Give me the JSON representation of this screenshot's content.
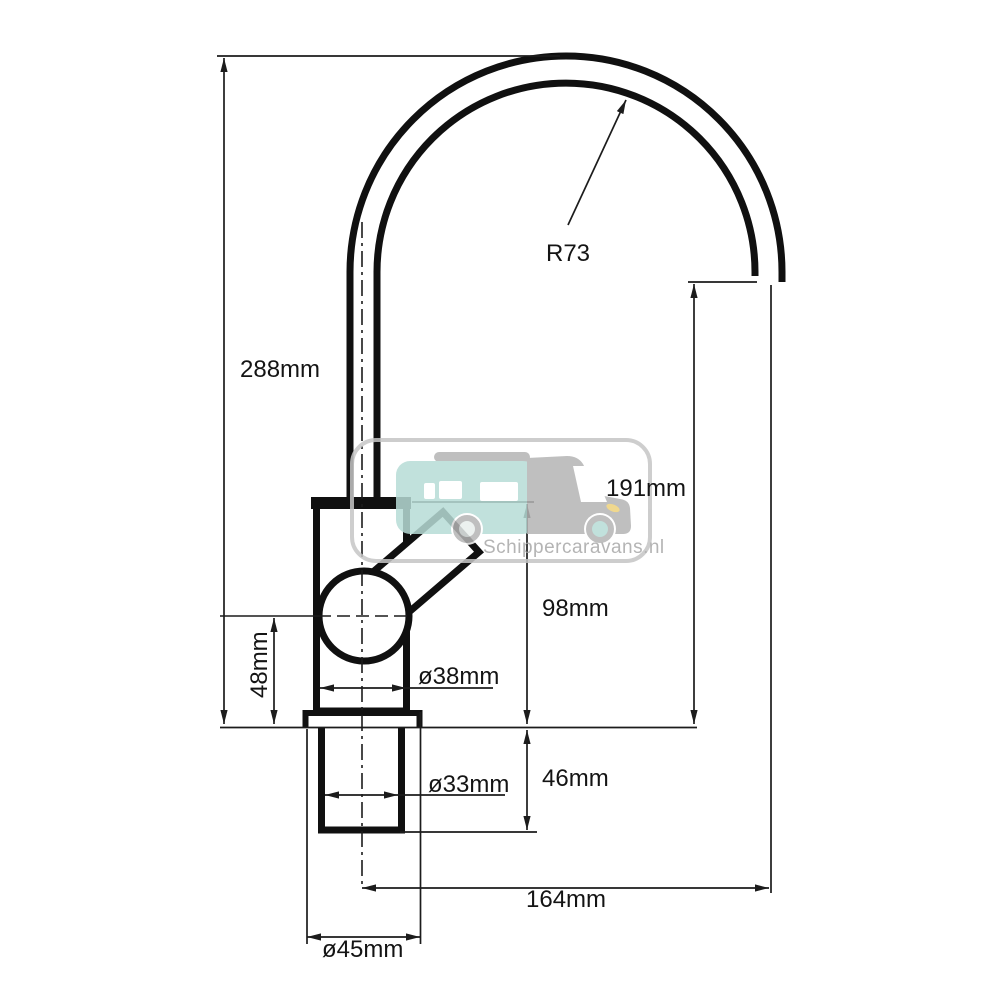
{
  "page": {
    "background": "#ffffff",
    "description": "Technical dimension drawing of a single-lever caravan faucet with gooseneck spout"
  },
  "diagram": {
    "type": "technical-drawing",
    "labels": {
      "overall_height": "288mm",
      "spout_radius": "R73",
      "spout_height": "191mm",
      "body_height": "98mm",
      "handle_axis_height": "48mm",
      "body_diameter": "ø38mm",
      "thread_diameter": "ø33mm",
      "thread_length": "46mm",
      "spout_reach": "164mm",
      "base_diameter": "ø45mm"
    },
    "colors": {
      "drawing_line": "#101010",
      "dimension_line": "#1c1c1c"
    }
  },
  "watermark": {
    "text": "Schippercaravans.nl",
    "colors": {
      "border": "#c5c5c5",
      "caravan_teal": "#b7dcd6",
      "caravan_gray": "#b4b4b4",
      "headlight_yellow": "#eed27b",
      "text_gray": "#a8a8a8"
    }
  }
}
